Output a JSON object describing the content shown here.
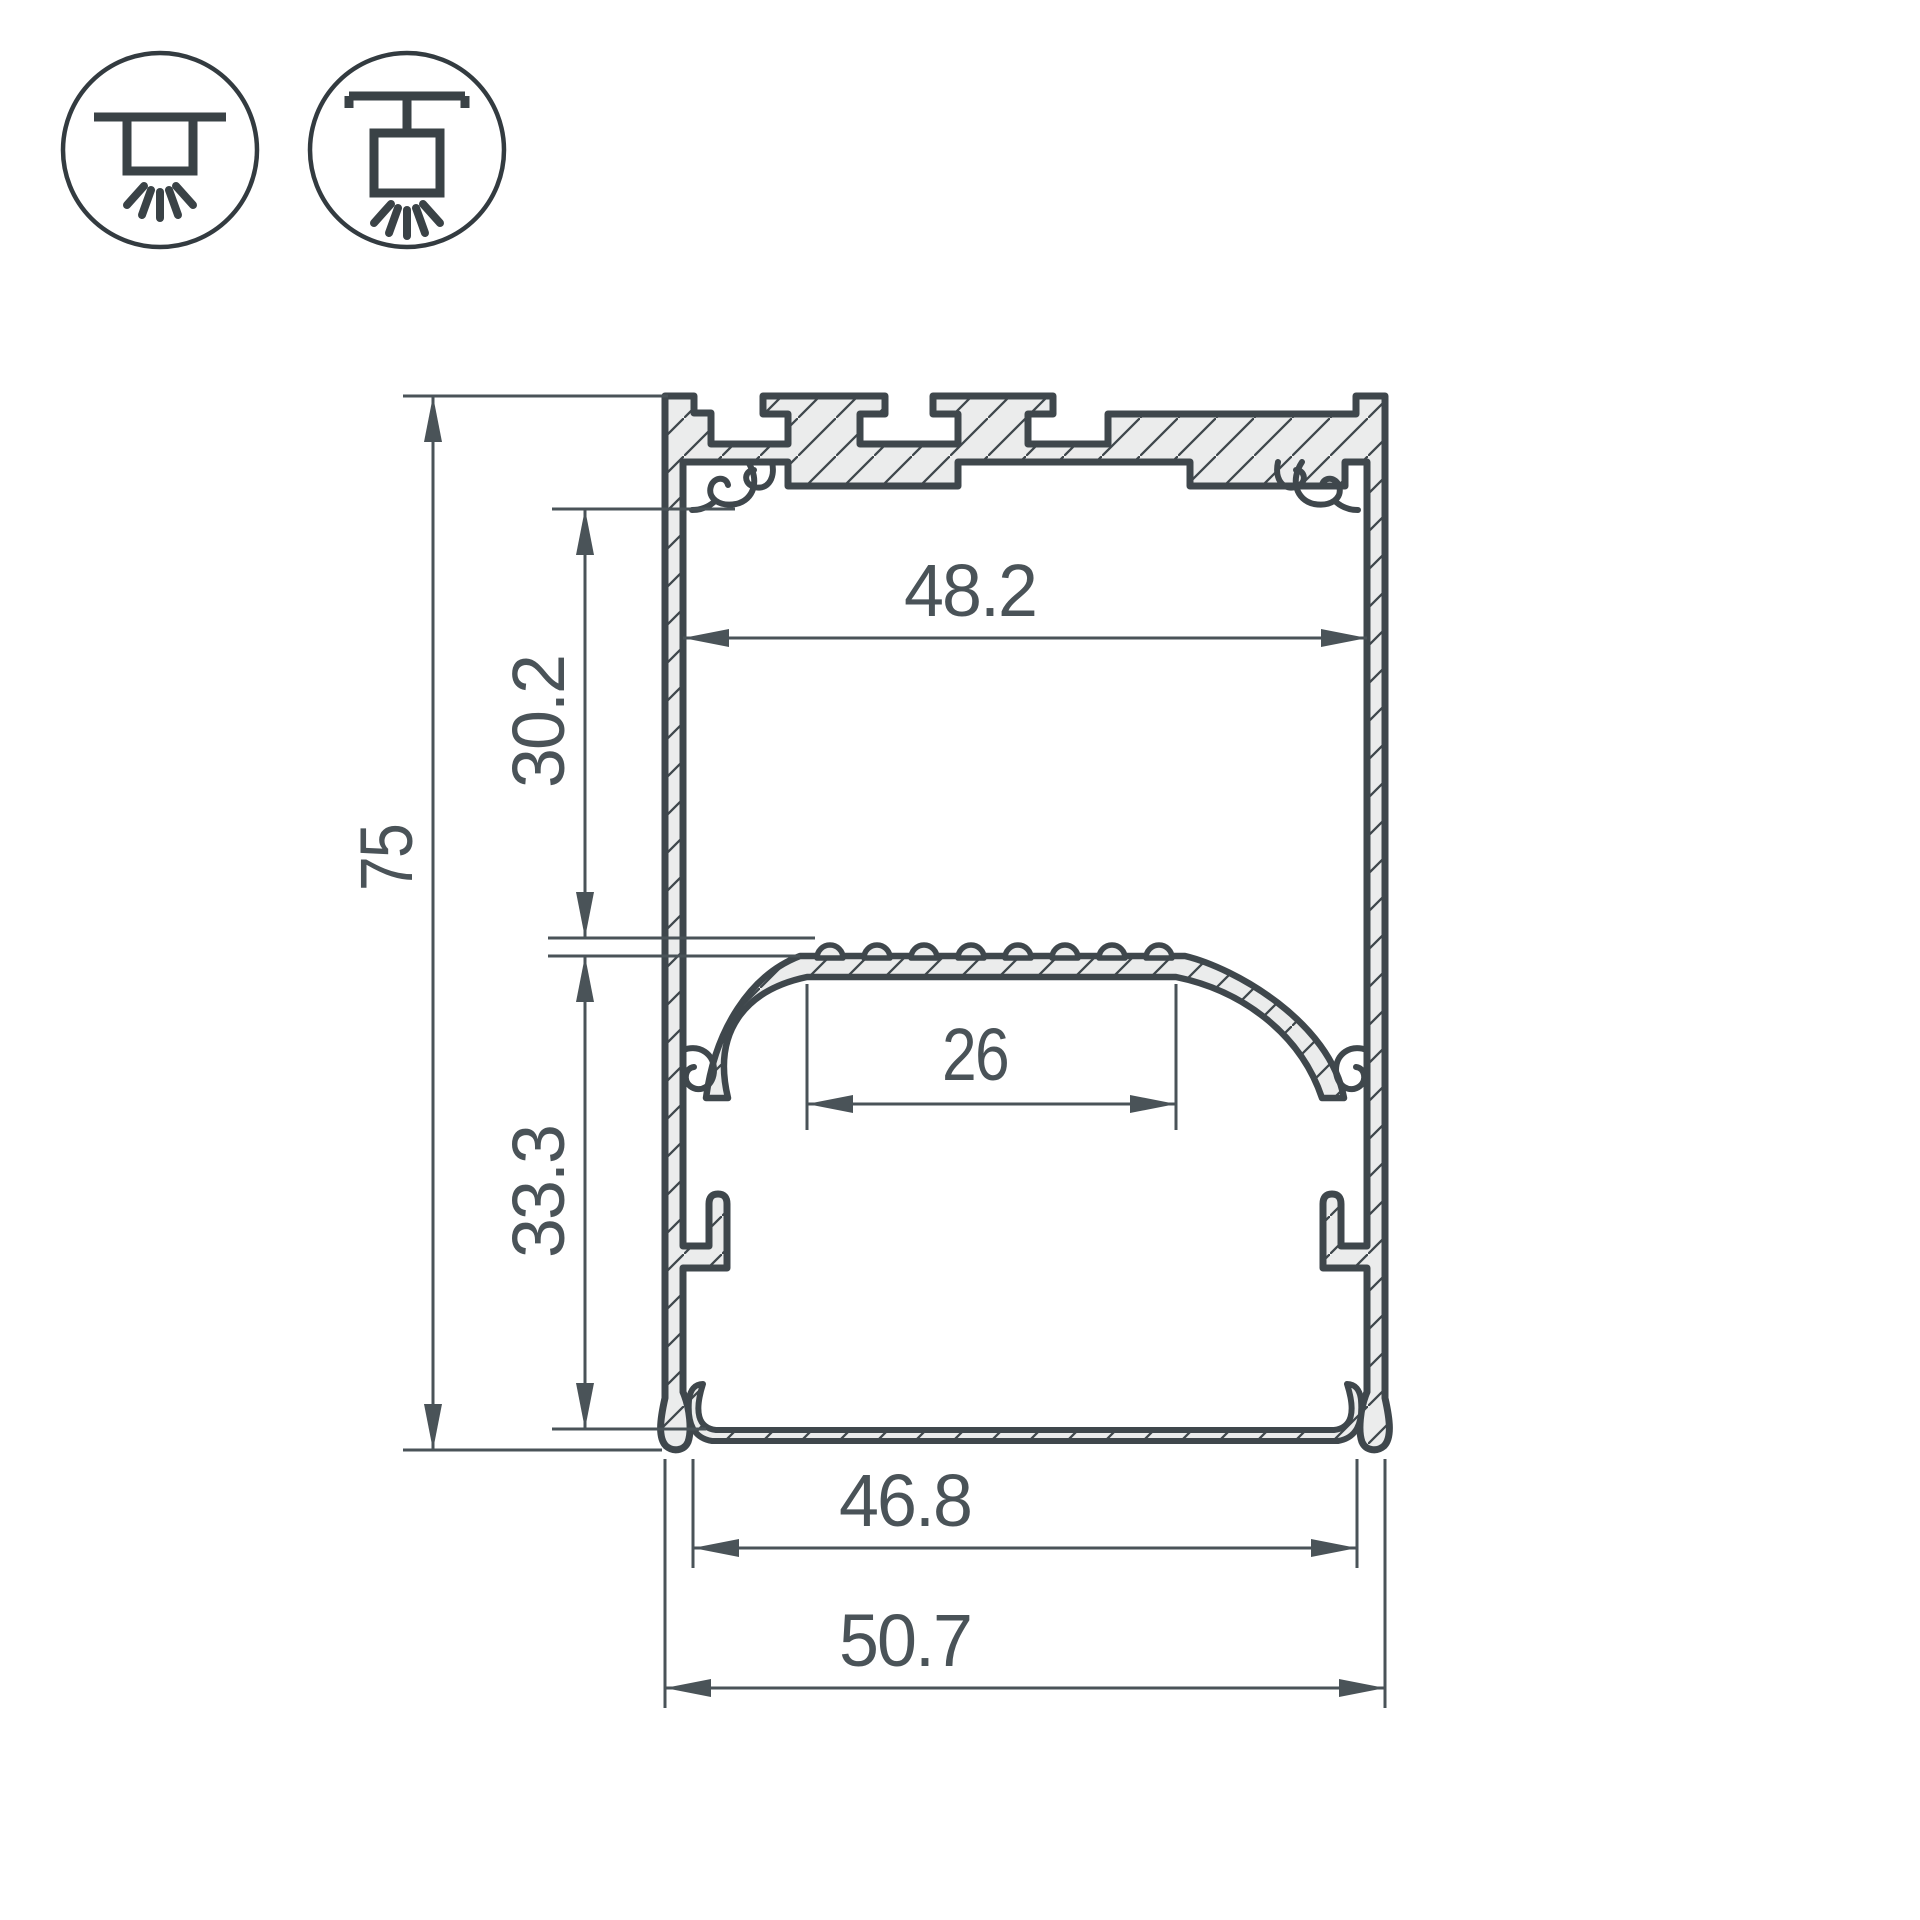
{
  "page": {
    "background": "#ffffff"
  },
  "drawing": {
    "type": "aluminium-led-profile-cross-section",
    "outline_color": "#3f474c",
    "dimension_color": "#4a5358",
    "metal_fill": "#ebecec",
    "icons": {
      "left": "surface-mount-luminaire-icon",
      "right": "suspended-luminaire-icon"
    },
    "dimensions": {
      "overall_height": "75",
      "upper_chamber_height": "30.2",
      "lower_chamber_height": "33.3",
      "top_inner_width": "48.2",
      "led_platform_width": "26",
      "bottom_inner_width": "46.8",
      "overall_width": "50.7"
    }
  }
}
